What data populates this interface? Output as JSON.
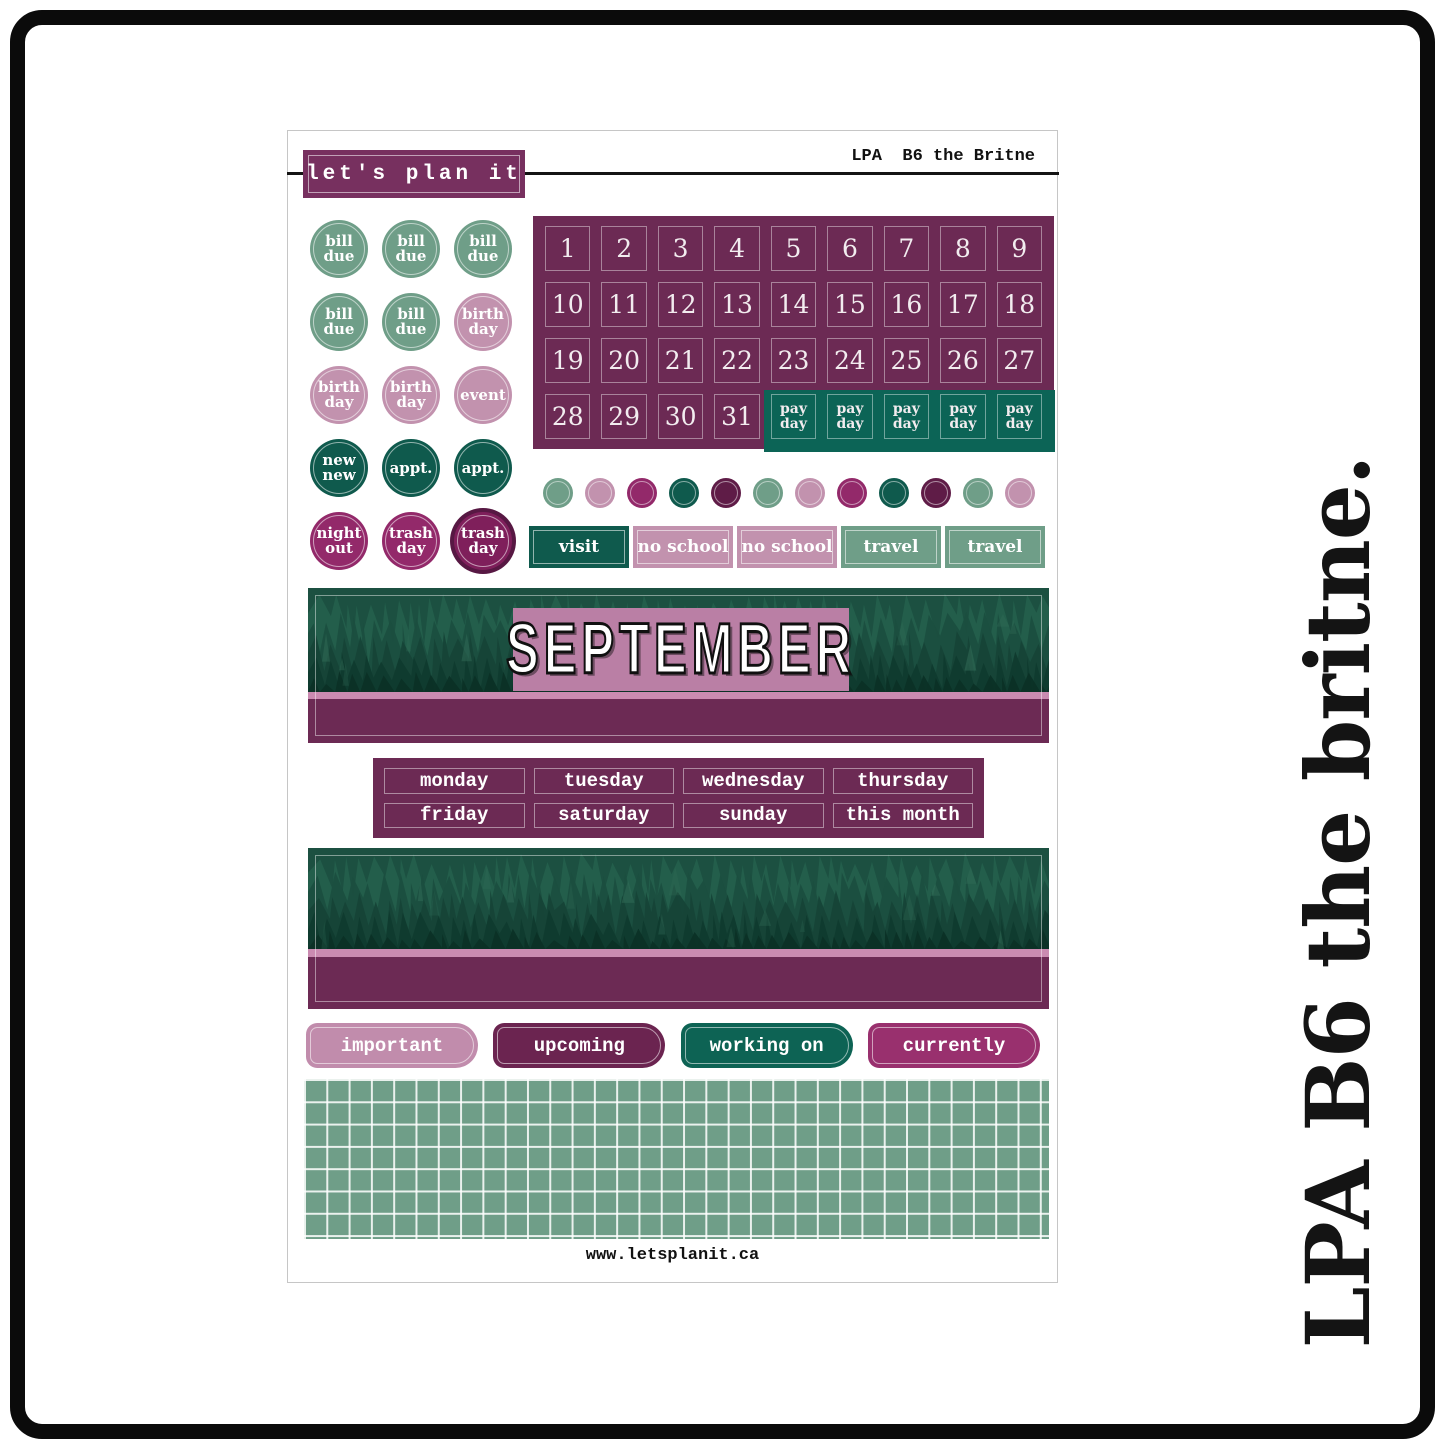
{
  "sheet": {
    "brand": "let's plan it",
    "header_right": "LPA  B6 the Britne",
    "url": "www.letsplanit.ca",
    "side_text": "LPA B6 the britne."
  },
  "colors": {
    "sage": "#6f9e88",
    "mauve": "#c292ae",
    "mauve_light": "#c18cac",
    "berry": "#93296a",
    "berry_bright": "#99306e",
    "berry_dark": "#7f1f5b",
    "berry_dark_ring": "#571843",
    "teal": "#0f5a4d",
    "teal_bright": "#0d6354",
    "teal_pay": "#0c6456",
    "plum": "#6c2a54",
    "plum_deep": "#6b2450",
    "plum_dark": "#5f1c47",
    "logo_plum": "#77305f",
    "pink_strip": "#ca8bb1",
    "sept_box": "#ba7fa5",
    "grid_green": "#6f9e88",
    "line_black": "#141414"
  },
  "circle_stickers": [
    {
      "label": "bill due",
      "color": "sage"
    },
    {
      "label": "bill due",
      "color": "sage"
    },
    {
      "label": "bill due",
      "color": "sage"
    },
    {
      "label": "bill due",
      "color": "sage"
    },
    {
      "label": "bill due",
      "color": "sage"
    },
    {
      "label": "birth day",
      "color": "mauve"
    },
    {
      "label": "birth day",
      "color": "mauve"
    },
    {
      "label": "birth day",
      "color": "mauve"
    },
    {
      "label": "event",
      "color": "mauve"
    },
    {
      "label": "new new",
      "color": "teal"
    },
    {
      "label": "appt.",
      "color": "teal"
    },
    {
      "label": "appt.",
      "color": "teal"
    },
    {
      "label": "night out",
      "color": "berry"
    },
    {
      "label": "trash day",
      "color": "berry"
    },
    {
      "label": "trash day",
      "color": "berry_dark",
      "variant": "ring"
    }
  ],
  "date_grid": {
    "numbers": [
      1,
      2,
      3,
      4,
      5,
      6,
      7,
      8,
      9,
      10,
      11,
      12,
      13,
      14,
      15,
      16,
      17,
      18,
      19,
      20,
      21,
      22,
      23,
      24,
      25,
      26,
      27,
      28,
      29,
      30,
      31
    ],
    "payday_label": "pay day",
    "payday_cells": 5
  },
  "dots": [
    "sage",
    "mauve",
    "berry",
    "teal",
    "plum_dark",
    "sage",
    "mauve",
    "berry",
    "teal",
    "plum_dark",
    "sage",
    "mauve"
  ],
  "event_labels": [
    {
      "label": "visit",
      "color": "teal"
    },
    {
      "label": "no school",
      "color": "mauve"
    },
    {
      "label": "no school",
      "color": "mauve"
    },
    {
      "label": "travel",
      "color": "sage"
    },
    {
      "label": "travel",
      "color": "sage"
    }
  ],
  "month_banner": {
    "title": "SEPTEMBER"
  },
  "weekday_labels": [
    "monday",
    "tuesday",
    "wednesday",
    "thursday",
    "friday",
    "saturday",
    "sunday",
    "this month"
  ],
  "category_labels": [
    {
      "label": "important",
      "color": "mauve_light"
    },
    {
      "label": "upcoming",
      "color": "plum_deep"
    },
    {
      "label": "working on",
      "color": "teal_bright"
    },
    {
      "label": "currently",
      "color": "berry_bright"
    }
  ]
}
